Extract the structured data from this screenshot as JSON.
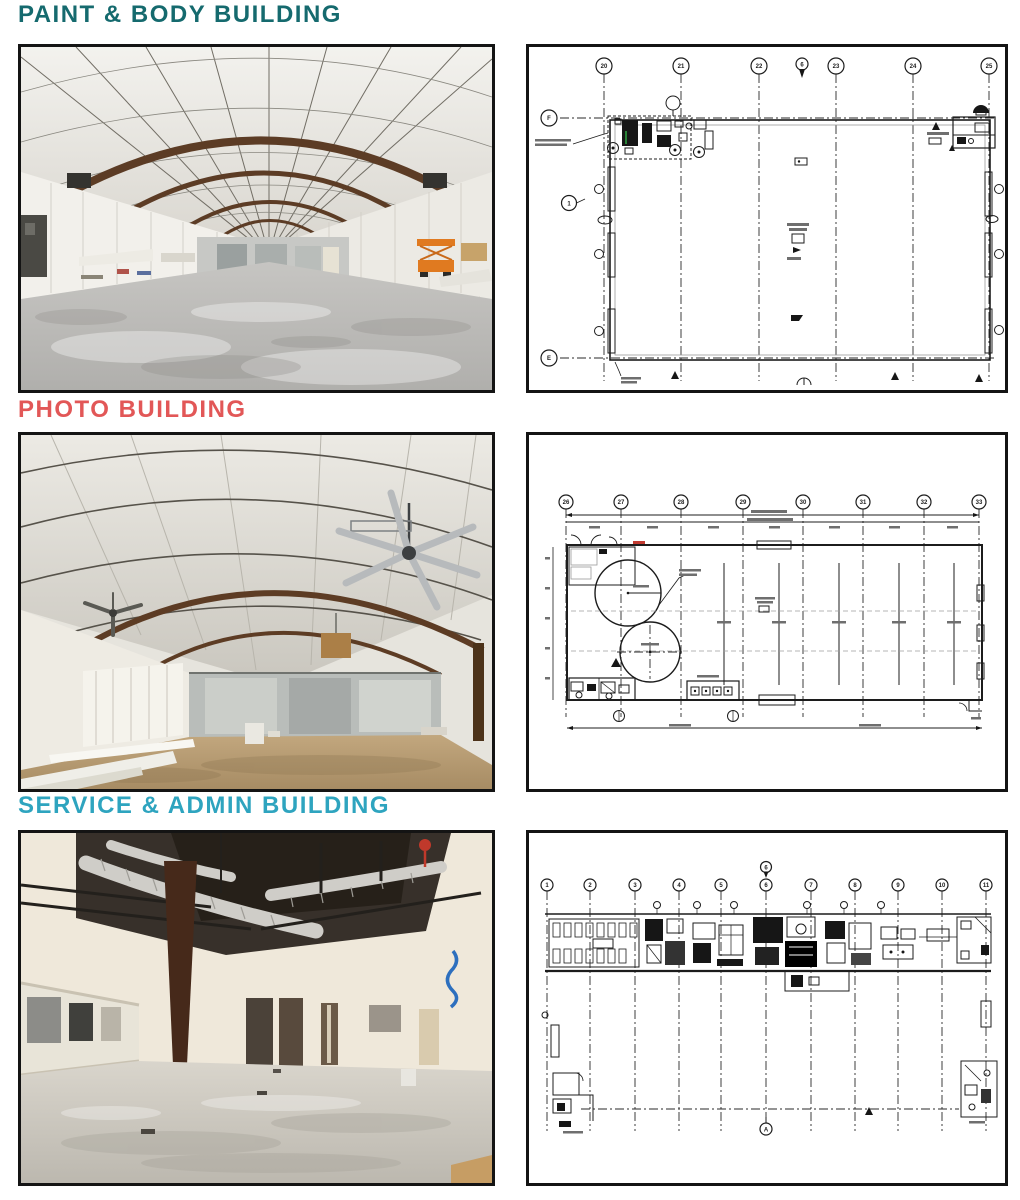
{
  "document": {
    "background": "#ffffff",
    "ink_color": "#1c1c1c"
  },
  "sections": [
    {
      "heading": "PAINT & BODY BUILDING",
      "heading_color": "#156a6e",
      "photo": {
        "name": "paint-body-interior-photo"
      },
      "plan": {
        "name": "paint-body-floor-plan",
        "column_bubbles": [
          "20",
          "21",
          "22",
          "23",
          "24",
          "25"
        ],
        "row_bubbles": [
          "F",
          "E"
        ],
        "keynote": "6",
        "detail_bubble": "1"
      }
    },
    {
      "heading": "PHOTO BUILDING",
      "heading_color": "#e25757",
      "photo": {
        "name": "photo-building-interior-photo"
      },
      "plan": {
        "name": "photo-building-floor-plan",
        "column_bubbles": [
          "26",
          "27",
          "28",
          "29",
          "30",
          "31",
          "32",
          "33"
        ],
        "red_note_color": "#c23b31"
      }
    },
    {
      "heading": "SERVICE & ADMIN BUILDING",
      "heading_color": "#2ea4bf",
      "photo": {
        "name": "service-admin-interior-photo"
      },
      "plan": {
        "name": "service-admin-floor-plan",
        "column_bubbles": [
          "1",
          "2",
          "3",
          "4",
          "5",
          "6",
          "7",
          "8",
          "9",
          "10",
          "11"
        ],
        "keynote": "6",
        "section_marker": "A"
      }
    }
  ]
}
